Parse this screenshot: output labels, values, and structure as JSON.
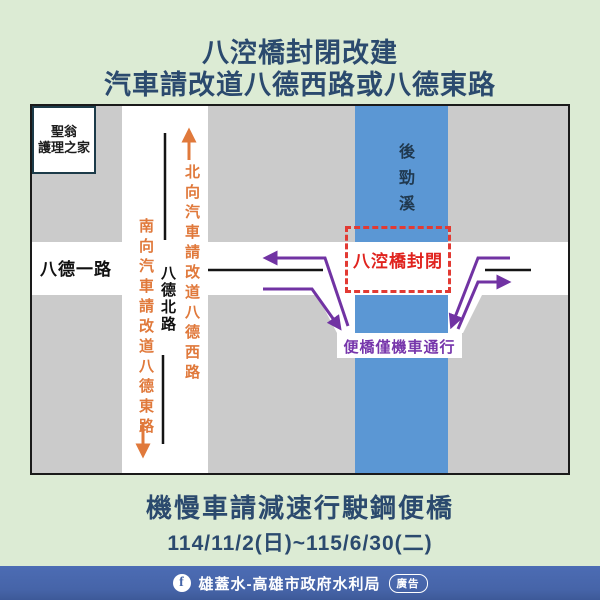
{
  "title": {
    "line1": "八涳橋封閉改建",
    "line2": "汽車請改道八德西路或八德東路"
  },
  "map": {
    "building": {
      "line1": "聖翁",
      "line2": "護理之家"
    },
    "road_west": "八德一路",
    "road_north": "八德北路",
    "river": "後勁溪",
    "closure": "八涳橋封閉",
    "temp_bridge": "便橋僅機車通行",
    "detour_north": "北向汽車請改道八德西路",
    "detour_south": "南向汽車請改道八德東路"
  },
  "notice": {
    "line1": "機慢車請減速行駛鋼便橋",
    "date": "114/11/2(日)~115/6/30(二)"
  },
  "footer": {
    "fb_glyph": "f",
    "brand": "雄蓋水-高雄市政府水利局",
    "ad_label": "廣告"
  },
  "colors": {
    "background_green": "#dcebd4",
    "title_navy": "#2b4a6e",
    "map_gray": "#cbcbcb",
    "river_blue": "#5b97d4",
    "detour_orange": "#e0793b",
    "motorcycle_purple": "#7133a3",
    "closure_red": "#e0231e",
    "footer_blue": "#4565a8"
  }
}
